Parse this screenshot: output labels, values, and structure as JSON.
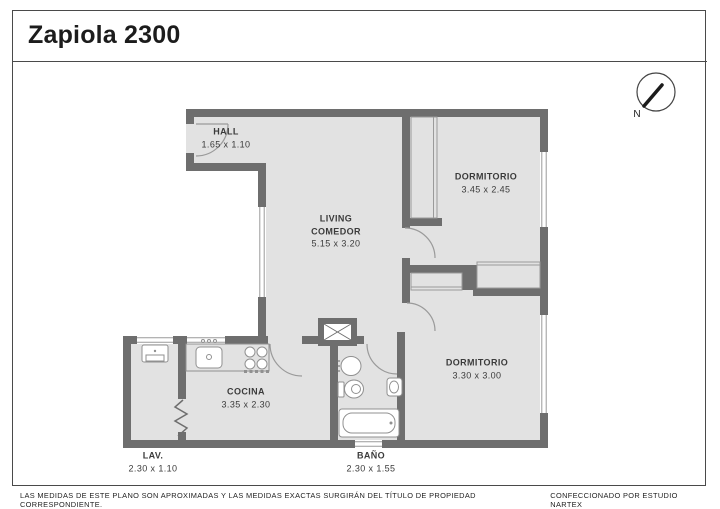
{
  "title": "Zapiola 2300",
  "compass": {
    "label": "N"
  },
  "rooms": [
    {
      "name": "HALL",
      "dims": "1.65 x 1.10"
    },
    {
      "name": "LIVING",
      "name2": "COMEDOR",
      "dims": "5.15 x 3.20"
    },
    {
      "name": "DORMITORIO",
      "dims": "3.45 x 2.45"
    },
    {
      "name": "DORMITORIO",
      "dims": "3.30 x 3.00"
    },
    {
      "name": "COCINA",
      "dims": "3.35 x 2.30"
    },
    {
      "name": "LAV.",
      "dims": "2.30 x 1.10"
    },
    {
      "name": "BAÑO",
      "dims": "2.30 x 1.55"
    }
  ],
  "footer": {
    "disclaimer": "LAS MEDIDAS  DE ESTE PLANO SON APROXIMADAS Y LAS MEDIDAS EXACTAS SURGIRÁN DEL TÍTULO DE PROPIEDAD CORRESPONDIENTE.",
    "credit": "CONFECCIONADO POR ESTUDIO NARTEX"
  },
  "colors": {
    "wall": "#6e6e6e",
    "floor": "#e2e2e2",
    "fixture_line": "#909090",
    "text": "#3b3b3b"
  }
}
